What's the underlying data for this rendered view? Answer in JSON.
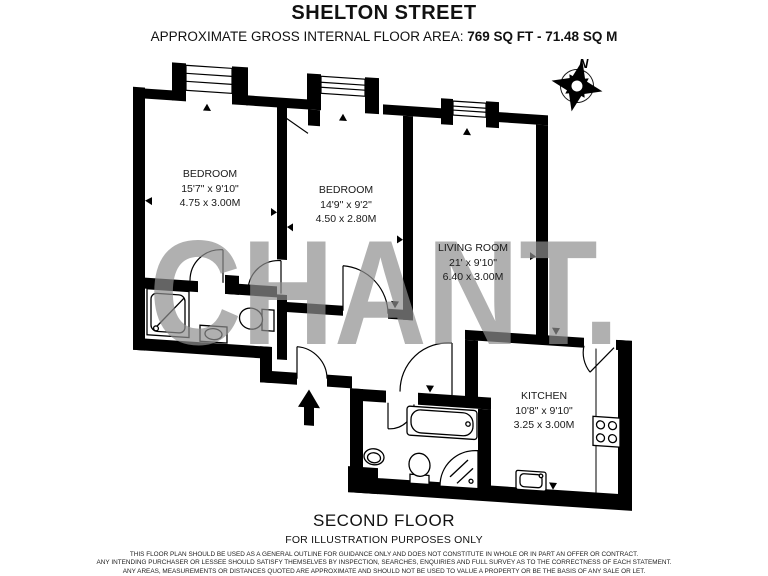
{
  "header": {
    "title": "SHELTON STREET",
    "area_label": "APPROXIMATE GROSS INTERNAL FLOOR AREA:",
    "area_value": "769 SQ FT  -  71.48 SQ M"
  },
  "compass": {
    "label": "N"
  },
  "watermark": {
    "text": "CHANT.",
    "color": "#8f8f8f"
  },
  "rooms": [
    {
      "name": "BEDROOM",
      "imperial": "15'7\" x 9'10\"",
      "metric": "4.75 x 3.00M"
    },
    {
      "name": "BEDROOM",
      "imperial": "14'9\" x 9'2\"",
      "metric": "4.50 x 2.80M"
    },
    {
      "name": "LIVING ROOM",
      "imperial": "21' x 9'10\"",
      "metric": "6.40 x 3.00M"
    },
    {
      "name": "KITCHEN",
      "imperial": "10'8\" x 9'10\"",
      "metric": "3.25 x 3.00M"
    }
  ],
  "footer": {
    "floor": "SECOND FLOOR",
    "purpose": "FOR ILLUSTRATION PURPOSES ONLY",
    "disclaimer": [
      "THIS FLOOR PLAN SHOULD BE USED AS A GENERAL OUTLINE FOR GUIDANCE ONLY AND DOES NOT CONSTITUTE IN WHOLE OR IN PART AN OFFER OR CONTRACT.",
      "ANY INTENDING PURCHASER OR LESSEE SHOULD SATISFY THEMSELVES BY INSPECTION, SEARCHES, ENQUIRIES AND FULL SURVEY AS TO THE CORRECTNESS OF EACH STATEMENT.",
      "ANY AREAS, MEASUREMENTS OR DISTANCES QUOTED ARE APPROXIMATE AND SHOULD NOT BE USED TO VALUE A PROPERTY OR BE THE BASIS OF ANY SALE OR LET."
    ]
  },
  "colors": {
    "wall": "#000000",
    "background": "#ffffff"
  }
}
